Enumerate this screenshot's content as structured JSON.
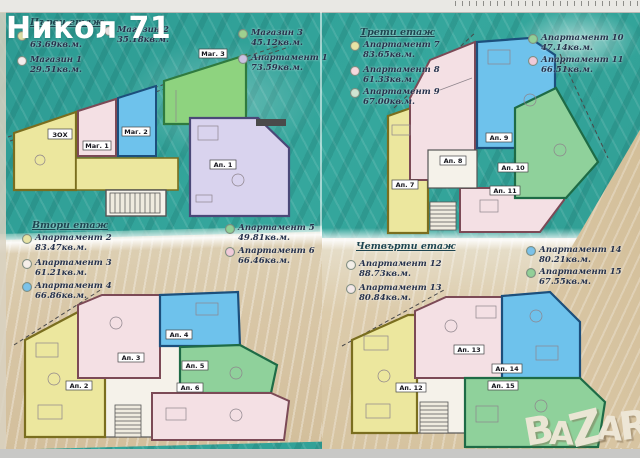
{
  "overlay": {
    "agency": "Никол 71"
  },
  "brand": {
    "name": "BAZAR"
  },
  "floors": [
    {
      "title": "Първи етаж",
      "entries": [
        {
          "label": "",
          "size": "63.69кв.м.",
          "bullet": "#dfe0a6"
        },
        {
          "label": "Магазин 1",
          "size": "29.51кв.м.",
          "bullet": "#f3ecec"
        },
        {
          "label": "Магазин 2",
          "size": "35.18кв.м.",
          "bullet": "#f3ecec"
        },
        {
          "label": "Магазин 3",
          "size": "45.12кв.м.",
          "bullet": "#9fd08f"
        },
        {
          "label": "Апартамент 1",
          "size": "73.59кв.м.",
          "bullet": "#ccc3e2"
        }
      ]
    },
    {
      "title": "Втори етаж",
      "entries": [
        {
          "label": "Апартамент 2",
          "size": "83.47кв.м.",
          "bullet": "#e7e3a5"
        },
        {
          "label": "Апартамент 3",
          "size": "61.21кв.м.",
          "bullet": "#f6efe9"
        },
        {
          "label": "Апартамент 4",
          "size": "66.86кв.м.",
          "bullet": "#7cc2e8"
        },
        {
          "label": "Апартамент 5",
          "size": "49.81кв.м.",
          "bullet": "#92cf98"
        },
        {
          "label": "Апартамент 6",
          "size": "66.46кв.м.",
          "bullet": "#f0cbd9"
        }
      ]
    },
    {
      "title": "Трети етаж",
      "entries": [
        {
          "label": "Апартамент 7",
          "size": "83.65кв.м.",
          "bullet": "#e7e3a5"
        },
        {
          "label": "Апартамент 8",
          "size": "61.33кв.м.",
          "bullet": "#f6d9dd"
        },
        {
          "label": "Апартамент 9",
          "size": "67.00кв.м.",
          "bullet": "#cfe4d2"
        },
        {
          "label": "Апартамент 10",
          "size": "47.14кв.м.",
          "bullet": "#92cf98"
        },
        {
          "label": "Апартамент 11",
          "size": "66.51кв.м.",
          "bullet": "#f0cbd9"
        }
      ]
    },
    {
      "title": "Четвърти етаж",
      "entries": [
        {
          "label": "Апартамент 12",
          "size": "88.73кв.м.",
          "bullet": "#f2efe8"
        },
        {
          "label": "Апартамент 13",
          "size": "80.84кв.м.",
          "bullet": "#f2e8e8"
        },
        {
          "label": "Апартамент 14",
          "size": "80.21кв.м.",
          "bullet": "#7cc2e8"
        },
        {
          "label": "Апартамент 15",
          "size": "67.55кв.м.",
          "bullet": "#92cf98"
        }
      ]
    }
  ],
  "plans": {
    "floor1": {
      "rooms": {
        "zox": "ЗОХ",
        "mag1": "Маг. 1",
        "mag2": "Маг. 2",
        "mag3": "Маг. 3",
        "ap1": "Ап. 1"
      }
    },
    "floor2": {
      "rooms": {
        "ap2": "Ап. 2",
        "ap3": "Ап. 3",
        "ap4": "Ап. 4",
        "ap5": "Ап. 5",
        "ap6": "Ап. 6"
      }
    },
    "floor3": {
      "rooms": {
        "ap7": "Ап. 7",
        "ap8": "Ап. 8",
        "ap9": "Ап. 9",
        "ap10": "Ап. 10",
        "ap11": "Ап. 11"
      }
    },
    "floor4": {
      "rooms": {
        "ap12": "Ап. 12",
        "ap13": "Ап. 13",
        "ap14": "Ап. 14",
        "ap15": "Ап. 15"
      }
    }
  }
}
